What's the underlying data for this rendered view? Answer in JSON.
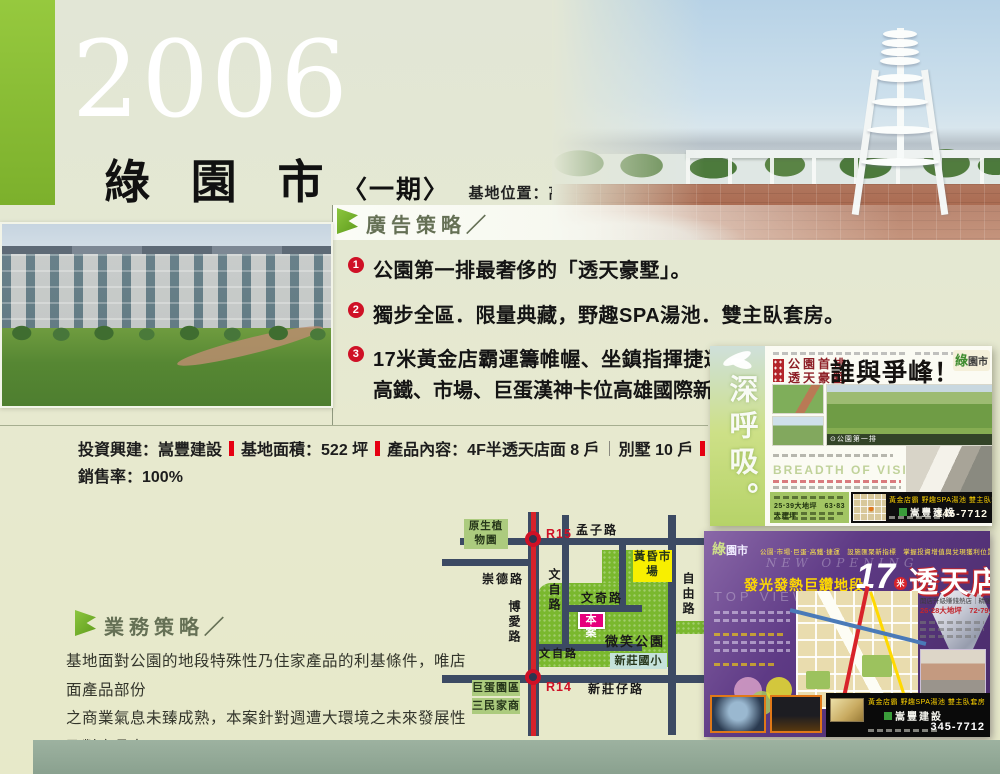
{
  "header": {
    "year": "2006",
    "project_name": "綠 園 市",
    "phase": "〈一期〉",
    "location": "基地位置：高雄市文奇路．文自路"
  },
  "ad_strategy": {
    "title": "廣告策略／",
    "bullets": [
      {
        "num": "1",
        "line1": "公園第一排最奢侈的「透天豪墅」。"
      },
      {
        "num": "2",
        "line1": "獨步全區．限量典藏，野趣SPA湯池．雙主臥套房。"
      },
      {
        "num": "3",
        "line1": "17米黃金店霸運籌帷幄、坐鎮指揮捷運、",
        "line2": "高鐵、市場、巨蛋漢神卡位高雄國際新都心。"
      }
    ]
  },
  "project_info": {
    "developer": "投資興建：嵩豐建設",
    "site_area": "基地面積：522 坪",
    "product": "產品內容：4F半透天店面 8 戶",
    "product2": "別墅 10 戶",
    "total_sales": "總銷金額：約 2.5 億",
    "sales_rate": "銷售率：100%"
  },
  "business_strategy": {
    "title": "業務策略／",
    "lines": [
      "基地面對公園的地段特殊性乃住家產品的利基條件，唯店面產品部份",
      "之商業氣息未臻成熟，本案針對週遭大環境之未來發展性及對產品力",
      "的強化包裝，以幹練的銷售手法達成本案的業績目標。"
    ]
  },
  "map": {
    "stations": {
      "r15": "R15",
      "r14": "R14"
    },
    "roads": {
      "mengzi": "孟子路",
      "chongde": "崇德路",
      "wenzi": "文自路",
      "wenqi": "文奇路",
      "boai": "博愛路",
      "ziyou": "自由路",
      "wenzi2": "文自路",
      "xinzhuangzai": "新莊仔路"
    },
    "places": {
      "botanic": "原生植物園",
      "market": "黃昏市場",
      "site": "本案",
      "park": "微笑公園",
      "school": "新莊國小",
      "dome": "巨蛋園區",
      "sanmin": "三民家商"
    }
  },
  "flyer1": {
    "vertical_slogan": "深呼吸。",
    "sub1": "公園首排",
    "sub2": "透天豪墅",
    "headline": "誰與爭峰！",
    "logo_green": "綠",
    "logo_rest": "園市",
    "photo_caption": "⊙公園第一排",
    "vision": "BREADTH OF VISION",
    "specs": "25‧39大地坪　63‧83大建坪",
    "bar_slogan": "黃金店霸 野趣SPA湯池 雙主臥套房",
    "builder": "嵩豐建設",
    "phone": "345-7712"
  },
  "flyer2": {
    "logo_green": "綠",
    "logo_rest": "園市",
    "top_line": "公園‧市場‧巨蛋‧高鐵‧捷運　設施匯聚新指標　掌握投資增值與兌現獲利位置！",
    "new_opening": "NEW OPENING",
    "headline_prefix": "發光發熱巨鑽地段",
    "headline_num": "17",
    "headline_mi": "米",
    "headline_main": "透天店",
    "top_view": "TOP VIEW",
    "right_title": "開店升級賺錢熱店｜精雕完工",
    "right_specs": "26‧28大地坪　72‧79大建坪",
    "bar_slogan": "黃金店霸 野趣SPA湯池 雙主臥套房",
    "builder": "嵩豐建設",
    "phone": "345-7712"
  }
}
